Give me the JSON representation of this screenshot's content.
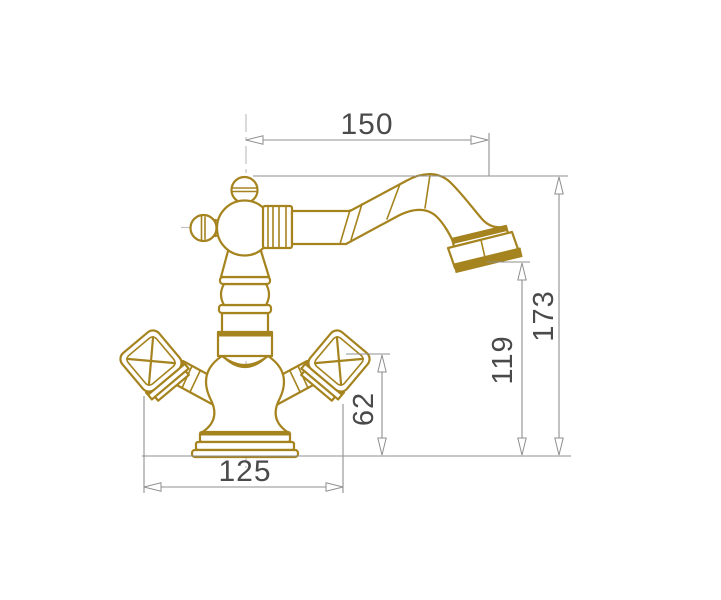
{
  "drawing": {
    "subject": "classic-two-handle-basin-faucet-side-elevation",
    "colors": {
      "outline": "#a5831e",
      "dimension_lines": "#8f8f8f",
      "dimension_text": "#4a4a4a",
      "centerlines": "#c2c2c2",
      "background": "#ffffff"
    },
    "dimensions": {
      "spout_reach": "150",
      "overall_height": "173",
      "spout_outlet_height": "119",
      "handle_top_height": "62",
      "overall_width": "125"
    }
  }
}
